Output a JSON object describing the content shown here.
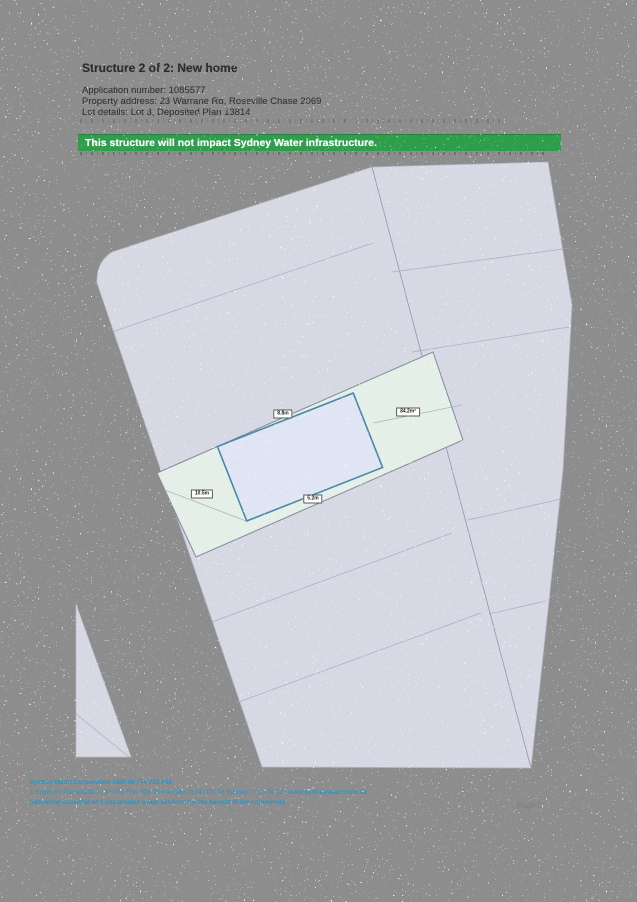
{
  "document": {
    "title": "Structure 2 of 2: New home",
    "fields": [
      {
        "label": "Application number:",
        "value": "1085577"
      },
      {
        "label": "Property address:",
        "value": "23 Warrane Rd, Roseville Chase 2069"
      },
      {
        "label": "Lot details:",
        "value": "Lot 3, Deposited Plan 13814"
      }
    ],
    "banner": {
      "text": "This structure will not impact Sydney Water infrastructure.",
      "color": "#2f9e4c"
    }
  },
  "plan": {
    "dimension_labels": {
      "top_width": "8.8m",
      "area": "84.2m²",
      "left_setback": "10.5m",
      "bottom_width": "5.2m"
    },
    "colors": {
      "parcel_fill": "#d6d8e4",
      "lot_strip_fill": "#e3efe7",
      "structure_fill": "#dfe5f2",
      "structure_stroke": "#4b89a7",
      "boundary_line": "#a2a6b8"
    }
  },
  "footer": {
    "line1": "Sydney Water Corporation ABN 49 776 225 038",
    "line2_main": "1 Smith St, Parramatta 2150 | PO Box 399, Parramatta 2124 | DX 14 Sydney | T 13 20 92 | ",
    "line2_url": "www.sydneywater.com.au",
    "line3": "Delivering essential and sustainable water services for the benefit of the community",
    "page_number": "Page 5",
    "color": "#1b9ad4"
  },
  "scan": {
    "background": "#8d8d8d"
  }
}
